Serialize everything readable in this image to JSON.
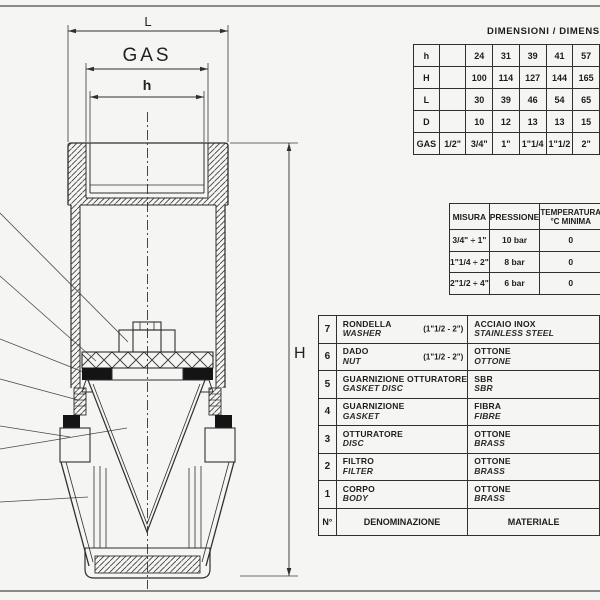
{
  "drawing": {
    "dim_L": "L",
    "dim_gas": "GAS",
    "dim_h": "h",
    "dim_H": "H"
  },
  "dimensions_table": {
    "title": "DIMENSIONI / DIMENSIONS",
    "rows": [
      {
        "label": "h",
        "values": [
          "",
          "24",
          "31",
          "39",
          "41",
          "57"
        ]
      },
      {
        "label": "H",
        "values": [
          "",
          "100",
          "114",
          "127",
          "144",
          "165"
        ]
      },
      {
        "label": "L",
        "values": [
          "",
          "30",
          "39",
          "46",
          "54",
          "65"
        ]
      },
      {
        "label": "D",
        "values": [
          "",
          "10",
          "12",
          "13",
          "13",
          "15"
        ]
      },
      {
        "label": "GAS",
        "values": [
          "1/2\"",
          "3/4\"",
          "1\"",
          "1\"1/4",
          "1\"1/2",
          "2\""
        ]
      }
    ]
  },
  "pressure_table": {
    "headers": {
      "misura": "MISURA",
      "pressione": "PRESSIONE",
      "temperatura_line1": "TEMPERATURA",
      "temperatura_line2": "°C MINIMA"
    },
    "rows": [
      {
        "misura": "3/4\" ÷ 1\"",
        "pressione": "10 bar",
        "temperatura": "0"
      },
      {
        "misura": "1\"1/4 ÷ 2\"",
        "pressione": "8 bar",
        "temperatura": "0"
      },
      {
        "misura": "2\"1/2 ÷ 4\"",
        "pressione": "6 bar",
        "temperatura": "0"
      }
    ]
  },
  "parts_table": {
    "footer": {
      "num": "N°",
      "denominazione": "DENOMINAZIONE",
      "materiale": "MATERIALE"
    },
    "rows": [
      {
        "num": "7",
        "name_it": "RONDELLA",
        "name_en": "WASHER",
        "note": "(1\"1/2 - 2\")",
        "mat_it": "ACCIAIO INOX",
        "mat_en": "STAINLESS STEEL"
      },
      {
        "num": "6",
        "name_it": "DADO",
        "name_en": "NUT",
        "note": "(1\"1/2 - 2\")",
        "mat_it": "OTTONE",
        "mat_en": "OTTONE"
      },
      {
        "num": "5",
        "name_it": "GUARNIZIONE OTTURATORE",
        "name_en": "GASKET DISC",
        "note": "",
        "mat_it": "SBR",
        "mat_en": "SBR"
      },
      {
        "num": "4",
        "name_it": "GUARNIZIONE",
        "name_en": "GASKET",
        "note": "",
        "mat_it": "FIBRA",
        "mat_en": "FIBRE"
      },
      {
        "num": "3",
        "name_it": "OTTURATORE",
        "name_en": "DISC",
        "note": "",
        "mat_it": "OTTONE",
        "mat_en": "BRASS"
      },
      {
        "num": "2",
        "name_it": "FILTRO",
        "name_en": "FILTER",
        "note": "",
        "mat_it": "OTTONE",
        "mat_en": "BRASS"
      },
      {
        "num": "1",
        "name_it": "CORPO",
        "name_en": "BODY",
        "note": "",
        "mat_it": "OTTONE",
        "mat_en": "BRASS"
      }
    ]
  }
}
